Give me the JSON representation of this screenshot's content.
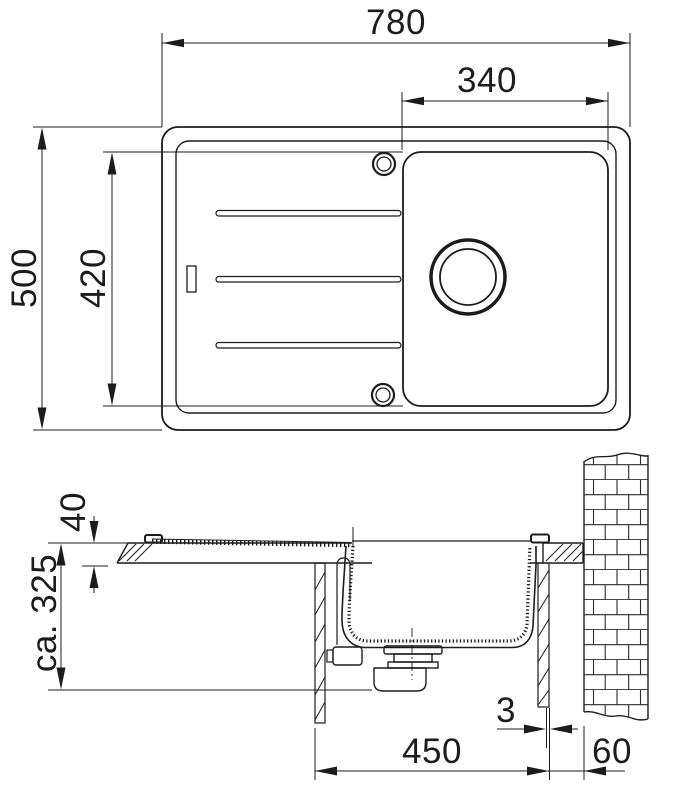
{
  "drawing": {
    "background": "#ffffff",
    "ink": "#1c1c1c",
    "description_names": {
      "top_view": "sink-plan-view",
      "section_view": "sink-section-view"
    }
  },
  "dimensions": {
    "overall_width": "780",
    "bowl_width": "340",
    "overall_depth": "500",
    "bowl_depth": "420",
    "rim_height": "40",
    "install_depth": "ca. 325",
    "edge_gap": "3",
    "cabinet_width": "450",
    "wall_clearance": "60"
  }
}
